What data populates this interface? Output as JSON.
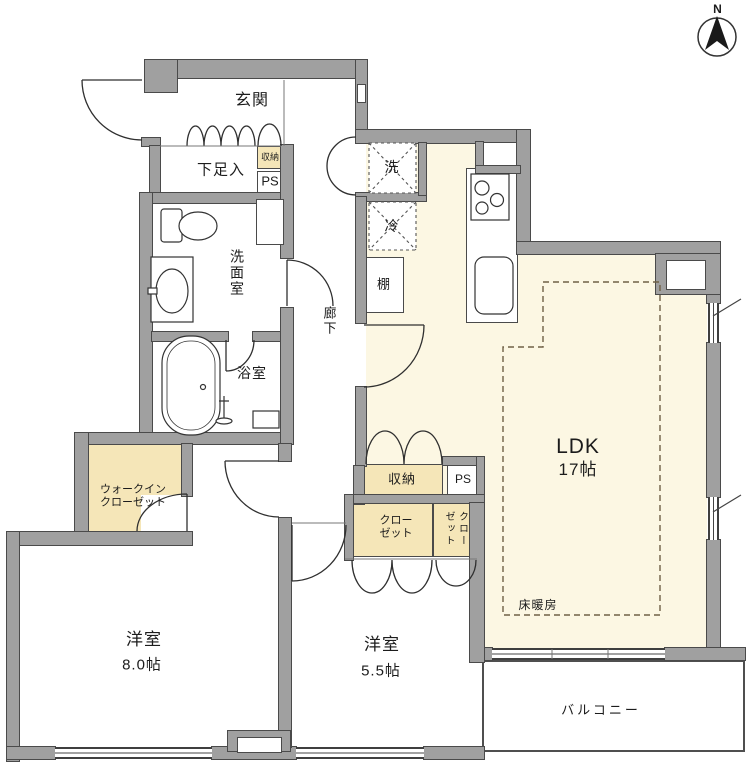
{
  "plan": {
    "compass_label": "N",
    "rooms": {
      "genkan": "玄関",
      "shoe_storage": "下足入",
      "entrance_storage": "収納",
      "washroom": "洗面室",
      "hallway": "廊下",
      "bathroom": "浴室",
      "washer": "洗",
      "fridge": "冷",
      "shelf": "棚",
      "ldk_name": "LDK",
      "ldk_size": "17帖",
      "floor_heating": "床暖房",
      "wic_line1": "ウォークイン",
      "wic_line2": "クローゼット",
      "mid_storage": "収納",
      "closet_line1": "クロー",
      "closet_line2": "ゼット",
      "closet2_col_left": "ゼット",
      "closet2_col_right": "クロー",
      "room8_name": "洋室",
      "room8_size": "8.0帖",
      "room55_name": "洋室",
      "room55_size": "5.5帖",
      "balcony": "バルコニー"
    },
    "ps": {
      "entrance": "PS",
      "entrance_vert_line1": "P",
      "entrance_vert_line2": "S",
      "kitchen": "PS",
      "ldk": "PS",
      "middle": "PS",
      "bottom": "PS"
    },
    "colors": {
      "wall_gray": "#a0a0a0",
      "room_cream": "#fcf7e3",
      "storage_yellow": "#f5e6b8"
    }
  }
}
